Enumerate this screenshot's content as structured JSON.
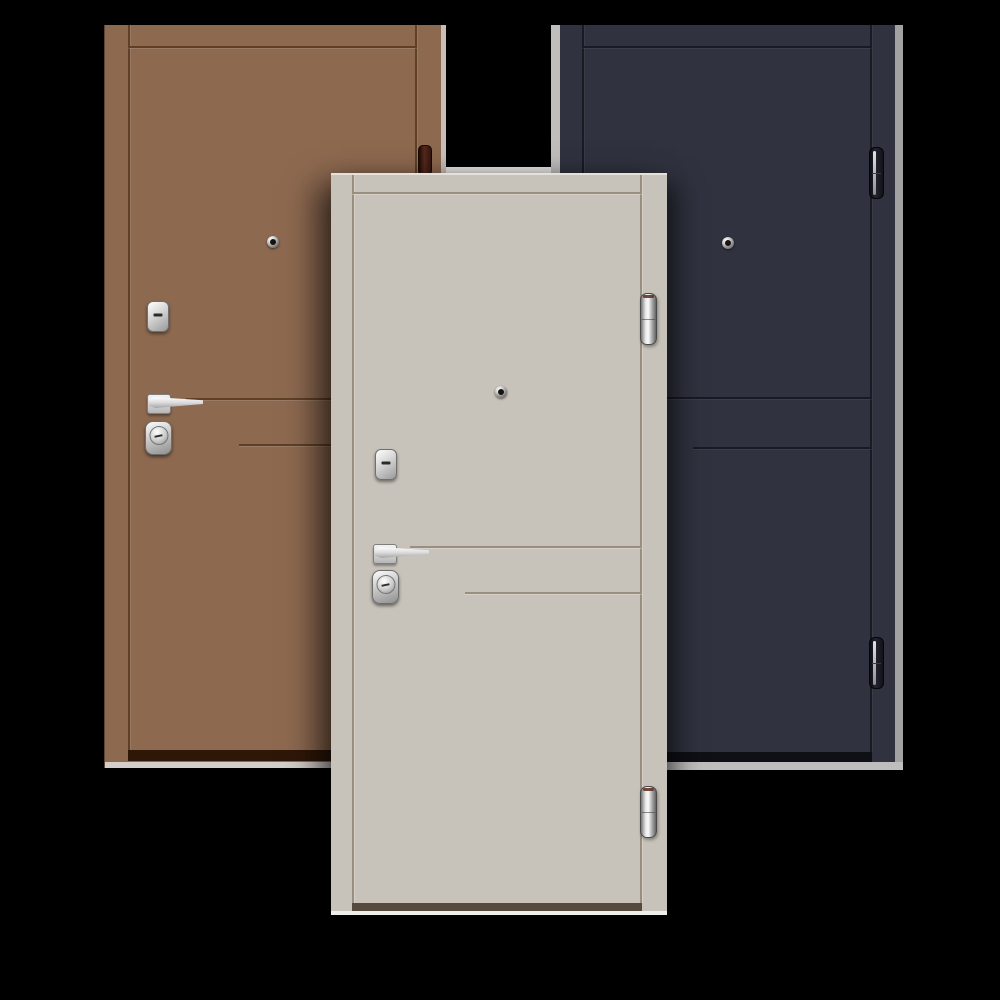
{
  "image": {
    "type": "product-render",
    "subject": "three steel entry doors on black background",
    "text_content": "none"
  },
  "palette": {
    "background": "#000000",
    "sliver": "#e9e8e6",
    "brownFace": "#8d6950",
    "brownGroove": "#5f4026",
    "brownDark": "#2f1708",
    "brownEdge": "#d3cec9",
    "grayFace": "#c8c3ba",
    "grayGroove": "#998f81",
    "grayDark": "#564a3e",
    "grayEdge": "#f0eeea",
    "navyFace": "#30333f",
    "navyGroove": "#191b24",
    "navyDark": "#0e1016",
    "navyEdge": "#c0bebc"
  },
  "doors": [
    {
      "name": "brown-door",
      "finish": "brown",
      "position": "left-back",
      "hardware": [
        "peephole",
        "keyhole-escutcheon",
        "lever-handle",
        "cylinder-lock",
        "hinge"
      ]
    },
    {
      "name": "beige-door",
      "finish": "light-gray-beige",
      "position": "center-front",
      "hardware": [
        "peephole",
        "keyhole-escutcheon",
        "lever-handle",
        "cylinder-lock",
        "hinge",
        "hinge"
      ]
    },
    {
      "name": "navy-door",
      "finish": "dark-navy",
      "position": "right-back",
      "hardware": [
        "peephole",
        "hinge",
        "hinge"
      ]
    }
  ]
}
